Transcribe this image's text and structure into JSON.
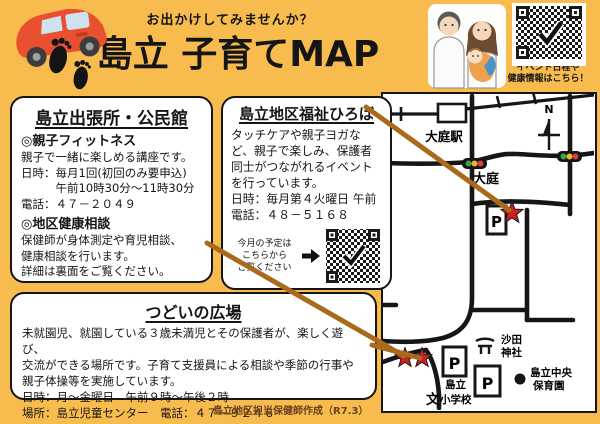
{
  "header": {
    "tagline": "お出かけしてみませんか？",
    "title": "島立 子育てMAP",
    "qr_caption_line1": "イベント日程や",
    "qr_caption_line2": "健康情報はこちら！"
  },
  "box_community_center": {
    "title": "島立出張所・公民館",
    "sections": [
      {
        "heading": "◎親子フィットネス",
        "lines": [
          "親子で一緒に楽しめる講座です。",
          "日時：毎月1回(初回のみ要申込)",
          "　　　午前10時30分～11時30分",
          "電話：４７－２０４９"
        ]
      },
      {
        "heading": "◎地区健康相談",
        "lines": [
          "保健師が身体測定や育児相談、",
          "健康相談を行います。",
          "詳細は裏面をご覧ください。"
        ]
      }
    ]
  },
  "box_fukushi_hiroba": {
    "title": "島立地区福祉ひろば",
    "lines": [
      "タッチケアや親子ヨガな",
      "ど、親子で楽しみ、保護者",
      "同士がつながれるイベント",
      "を行っています。",
      "日時：毎月第４火曜日 午前",
      "電話：４８－５１６８"
    ],
    "qr_note_line1": "今月の予定は",
    "qr_note_line2": "こちらから",
    "qr_note_line3": "ご覧ください"
  },
  "box_tsudoi": {
    "title": "つどいの広場",
    "lines": [
      "未就園児、就園している３歳未満児とその保護者が、楽しく遊び、",
      "交流ができる場所です。子育て支援員による相談や季節の行事や",
      "親子体操等を実施しています。",
      "日時：月～金曜日　午前９時～午後２時",
      "場所：島立児童センター　電話：４７－９２４６"
    ]
  },
  "footer": {
    "credit": "島立地区担当保健師作成（R7.3）"
  },
  "map": {
    "labels": {
      "station": "大庭駅",
      "oba": "大庭",
      "north": "N",
      "parking": "P",
      "shrine_line1": "沙田",
      "shrine_line2": "神社",
      "nursery_line1": "島立中央",
      "nursery_line2": "保育園",
      "school_line1": "島立",
      "school_line2": "小学校",
      "school_symbol": "文"
    }
  },
  "colors": {
    "background": "#f8bb4e",
    "box_border": "#161616",
    "connector_line": "#a96a1c",
    "star_red": "#cc1f1f",
    "car_red": "#e8502f",
    "traffic_green": "#43a047",
    "traffic_yellow": "#f2b233",
    "traffic_red": "#d23f44",
    "credit_text": "#6d4320"
  }
}
